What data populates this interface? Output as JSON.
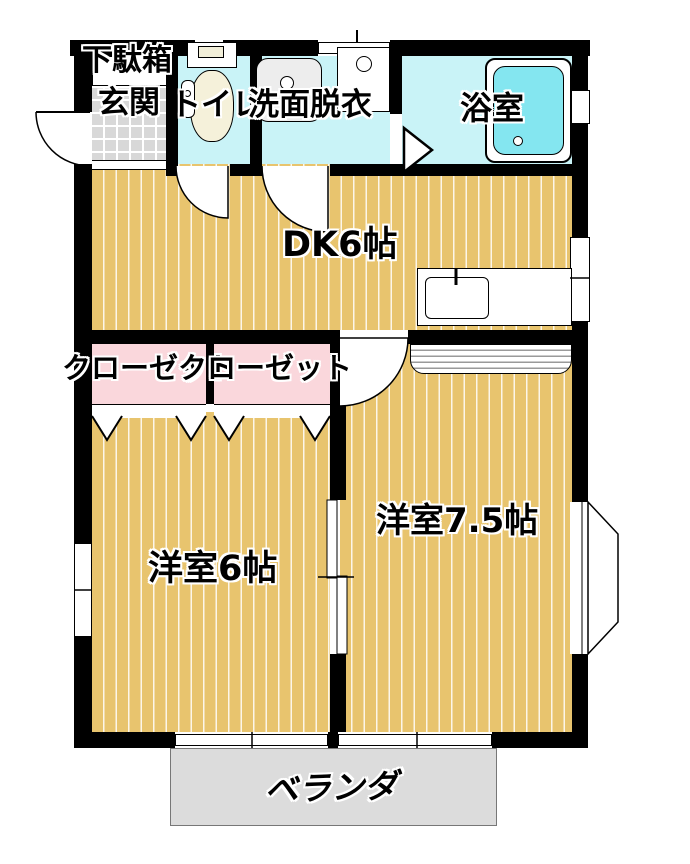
{
  "plan_title": "2DK apartment floor plan",
  "rooms": {
    "getabako": {
      "label": "下駄箱"
    },
    "genkan": {
      "label": "玄関"
    },
    "toilet": {
      "label": "トイレ"
    },
    "washroom": {
      "label": "洗面脱衣"
    },
    "bathroom": {
      "label": "浴室"
    },
    "dk": {
      "label": "DK6帖",
      "size_jo": 6
    },
    "closet_left": {
      "label": "クローゼット"
    },
    "closet_right": {
      "label": "クローゼット"
    },
    "western_room_6": {
      "label": "洋室6帖",
      "size_jo": 6
    },
    "western_room_7_5": {
      "label": "洋室7.5帖",
      "size_jo": 7.5
    },
    "veranda": {
      "label": "ベランダ"
    }
  },
  "fixtures": [
    "entrance-swing-door",
    "toilet",
    "vanity-sink",
    "washing-machine",
    "bathtub",
    "bath-folding-door",
    "kitchen-counter-sink",
    "closet-folding-doors",
    "room-sliding-door",
    "bay-window",
    "sliding-windows"
  ],
  "colors": {
    "wall": "#000000",
    "wood_floor": "#E8C46E",
    "wood_stripe": "#FAF0CC",
    "wet_area_floor": "#C9F3F7",
    "bathtub": "#84E6F0",
    "closet": "#FAD7DC",
    "entrance_tile": "#D8D8D8",
    "veranda": "#DCDCDC"
  }
}
